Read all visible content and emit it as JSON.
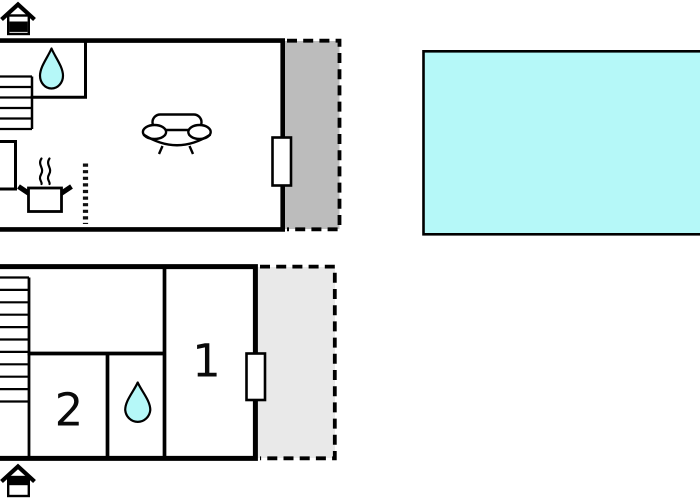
{
  "document": {
    "kind": "holiday-home-floor-plan",
    "floors": 2,
    "visible_text": [
      "1",
      "2"
    ]
  },
  "colors": {
    "background": "#ffffff",
    "wall": "#000000",
    "water": "#b5f8f8",
    "terrace_upper_fill": "#bcbcbc",
    "terrace_lower_fill": "#e9e9e9",
    "fixture_fill": "#ffffff"
  },
  "upper_floor": {
    "name": "upper-floor",
    "icons": [
      "house-entrance-icon",
      "staircase-icon",
      "water-drop-icon",
      "cooking-pot-icon",
      "steam-icon",
      "sofa-icon",
      "window-marker",
      "dotted-counter-divider"
    ],
    "terrace_style": "gray-area-dashed-outline"
  },
  "lower_floor": {
    "name": "lower-floor",
    "rooms": {
      "bedroom1_label": "1",
      "bedroom2_label": "2"
    },
    "icons": [
      "house-entrance-icon",
      "staircase-icon",
      "water-drop-icon",
      "window-marker"
    ],
    "terrace_style": "light-gray-area-dashed-outline"
  },
  "pool": {
    "name": "swimming-pool"
  }
}
